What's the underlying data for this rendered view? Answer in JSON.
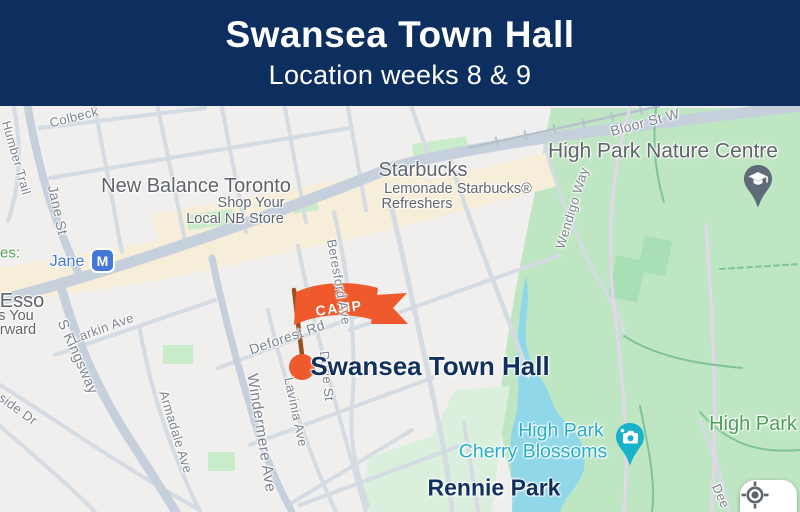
{
  "header": {
    "title": "Swansea Town Hall",
    "subtitle": "Location weeks 8 & 9"
  },
  "map": {
    "camp_flag": {
      "label": "CAMP"
    },
    "town_hall_marker": {
      "label": "Swansea Town Hall"
    },
    "jane_station": {
      "badge": "M",
      "label": "Jane"
    },
    "pins": [
      {
        "id": "nature-centre-pin",
        "icon": "graduation-cap-icon"
      },
      {
        "id": "cherry-blossoms-pin",
        "icon": "camera-icon"
      }
    ],
    "controls": {
      "my_location": {
        "icon": "crosshair-icon"
      }
    },
    "labels": [
      {
        "id": "colbeck",
        "text": "Colbeck",
        "kind": "street",
        "x": 74,
        "y": 11,
        "rot": -14,
        "size": 13
      },
      {
        "id": "humber-trail",
        "text": "Humber Trail",
        "kind": "street",
        "x": 16,
        "y": 52,
        "rot": 74,
        "size": 12.5
      },
      {
        "id": "jane-st",
        "text": "Jane St",
        "kind": "street",
        "x": 58,
        "y": 104,
        "rot": 78,
        "size": 14
      },
      {
        "id": "s-kingsway",
        "text": "S Kingsway",
        "kind": "street",
        "x": 77,
        "y": 251,
        "rot": 66,
        "size": 14.5
      },
      {
        "id": "side-dr",
        "text": "side Dr",
        "kind": "street",
        "x": 18,
        "y": 303,
        "rot": 36,
        "size": 13
      },
      {
        "id": "larkin-ave",
        "text": "Larkin Ave",
        "kind": "street",
        "x": 103,
        "y": 222,
        "rot": -20,
        "size": 13
      },
      {
        "id": "armadale-ave",
        "text": "Armadale Ave",
        "kind": "street",
        "x": 176,
        "y": 326,
        "rot": 73,
        "size": 13
      },
      {
        "id": "windermere-ave",
        "text": "Windermere Ave",
        "kind": "street",
        "x": 261,
        "y": 327,
        "rot": 81,
        "size": 15.5
      },
      {
        "id": "lavinia-ave",
        "text": "Lavinia Ave",
        "kind": "street",
        "x": 296,
        "y": 306,
        "rot": 78,
        "size": 13
      },
      {
        "id": "durie-st",
        "text": "Durie St",
        "kind": "street",
        "x": 327,
        "y": 270,
        "rot": 84,
        "size": 13
      },
      {
        "id": "beresford-ave",
        "text": "Beresford Ave",
        "kind": "street",
        "x": 339,
        "y": 176,
        "rot": 80,
        "size": 13
      },
      {
        "id": "deforest-rd",
        "text": "Deforest Rd",
        "kind": "street",
        "x": 287,
        "y": 231,
        "rot": -19,
        "size": 14
      },
      {
        "id": "wendigo-way",
        "text": "Wendigo Way",
        "kind": "street",
        "x": 572,
        "y": 102,
        "rot": -73,
        "size": 13
      },
      {
        "id": "bloor-st-w",
        "text": "Bloor St W",
        "kind": "street",
        "x": 645,
        "y": 16,
        "rot": -15,
        "size": 14
      },
      {
        "id": "deer-pen-rd",
        "text": "Dee",
        "kind": "street",
        "x": 721,
        "y": 390,
        "rot": 66,
        "size": 13
      },
      {
        "id": "new-balance",
        "text": "New Balance Toronto",
        "kind": "poi",
        "x": 196,
        "y": 80,
        "rot": 0,
        "size": 20
      },
      {
        "id": "new-balance-sub1",
        "text": "Shop Your",
        "kind": "poi-sub",
        "x": 251,
        "y": 97,
        "rot": 0,
        "size": 14.5
      },
      {
        "id": "new-balance-sub2",
        "text": "Local NB Store",
        "kind": "poi-sub",
        "x": 235,
        "y": 113,
        "rot": 0,
        "size": 14.5
      },
      {
        "id": "starbucks",
        "text": "Starbucks",
        "kind": "poi",
        "x": 423,
        "y": 64,
        "rot": 0,
        "size": 20
      },
      {
        "id": "starbucks-sub1",
        "text": "Lemonade Starbucks®",
        "kind": "poi-sub",
        "x": 458,
        "y": 83,
        "rot": 0,
        "size": 14.5
      },
      {
        "id": "starbucks-sub2",
        "text": "Refreshers",
        "kind": "poi-sub",
        "x": 417,
        "y": 98,
        "rot": 0,
        "size": 14.5
      },
      {
        "id": "esso",
        "text": "Esso",
        "kind": "poi",
        "x": 22,
        "y": 195,
        "rot": 0,
        "size": 20
      },
      {
        "id": "esso-sub1",
        "text": "s You",
        "kind": "poi-sub",
        "x": 16,
        "y": 210,
        "rot": 0,
        "size": 14.5
      },
      {
        "id": "esso-sub2",
        "text": "rward",
        "kind": "poi-sub",
        "x": 18,
        "y": 224,
        "rot": 0,
        "size": 14.5
      },
      {
        "id": "es",
        "text": "es:",
        "kind": "green",
        "x": 10,
        "y": 147,
        "rot": 0,
        "size": 15,
        "inter": false
      },
      {
        "id": "hp-nature-centre",
        "text": "High Park Nature Centre",
        "kind": "poi",
        "x": 663,
        "y": 45,
        "rot": 0,
        "size": 21
      },
      {
        "id": "high-park",
        "text": "High Park",
        "kind": "green",
        "x": 753,
        "y": 318,
        "rot": 0,
        "size": 20
      },
      {
        "id": "hp-cherry-1",
        "text": "High Park",
        "kind": "teal",
        "x": 561,
        "y": 325,
        "rot": 0,
        "size": 19.5
      },
      {
        "id": "hp-cherry-2",
        "text": "Cherry Blossoms",
        "kind": "teal",
        "x": 533,
        "y": 346,
        "rot": 0,
        "size": 19.5
      },
      {
        "id": "rennie-park",
        "text": "Rennie Park",
        "kind": "navy",
        "x": 494,
        "y": 382,
        "rot": 0,
        "size": 23
      },
      {
        "id": "jane-station-label",
        "text": "Jane",
        "kind": "blue",
        "x": 67,
        "y": 156,
        "rot": 0,
        "size": 16
      },
      {
        "id": "town-hall-label",
        "text": "Swansea Town Hall",
        "kind": "navy",
        "x": 430,
        "y": 260,
        "rot": 0,
        "size": 26,
        "inter": false
      }
    ],
    "colors": {
      "header_bg": "#0d2f5f",
      "navy_text": "#12305e",
      "orange": "#ee5a2b",
      "flag_pole": "#9a4f22",
      "park_green": "#bfe6c3",
      "park_light": "#daf0dc",
      "field_green": "#a9dfb4",
      "water": "#8fd7e9",
      "commercial_beige": "#f6eed8",
      "road_major": "#c5d0dc",
      "road_minor": "#d4dbe2",
      "rail": "#b6c1cc",
      "street_label": "#7c838c",
      "poi_label": "#5f646a",
      "green_label": "#4f9e58",
      "teal_label": "#23aec5",
      "transit_blue": "#4577d8",
      "pin_slate": "#5f6b78",
      "pin_teal": "#17b3ca",
      "map_bg": "#f0efed"
    }
  }
}
